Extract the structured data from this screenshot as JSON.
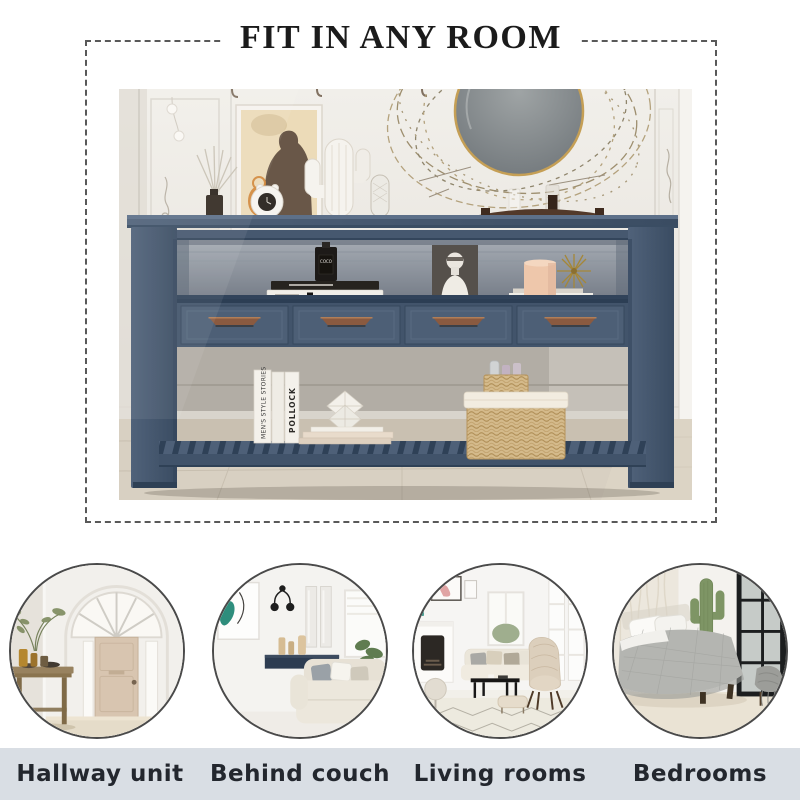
{
  "title": "FIT IN ANY ROOM",
  "usages": [
    {
      "label": "Hallway unit"
    },
    {
      "label": "Behind couch"
    },
    {
      "label": "Living rooms"
    },
    {
      "label": "Bedrooms"
    }
  ],
  "photo_text": {
    "book_spine_large": "MEN'S STYLE STORIES",
    "book_spine_pollock": "POLLOCK",
    "book_spine_chanel": "COCO CHANEL",
    "perfume_label": "COCO"
  },
  "colors": {
    "band_bg": "#d9dee4",
    "label_text": "#23272e",
    "title_text": "#1b1b1b",
    "dash_border": "#595959",
    "navy": "#46586f",
    "navy_dark": "#3a4c62",
    "navy_light": "#54677e",
    "handle": "#8a5a40"
  }
}
